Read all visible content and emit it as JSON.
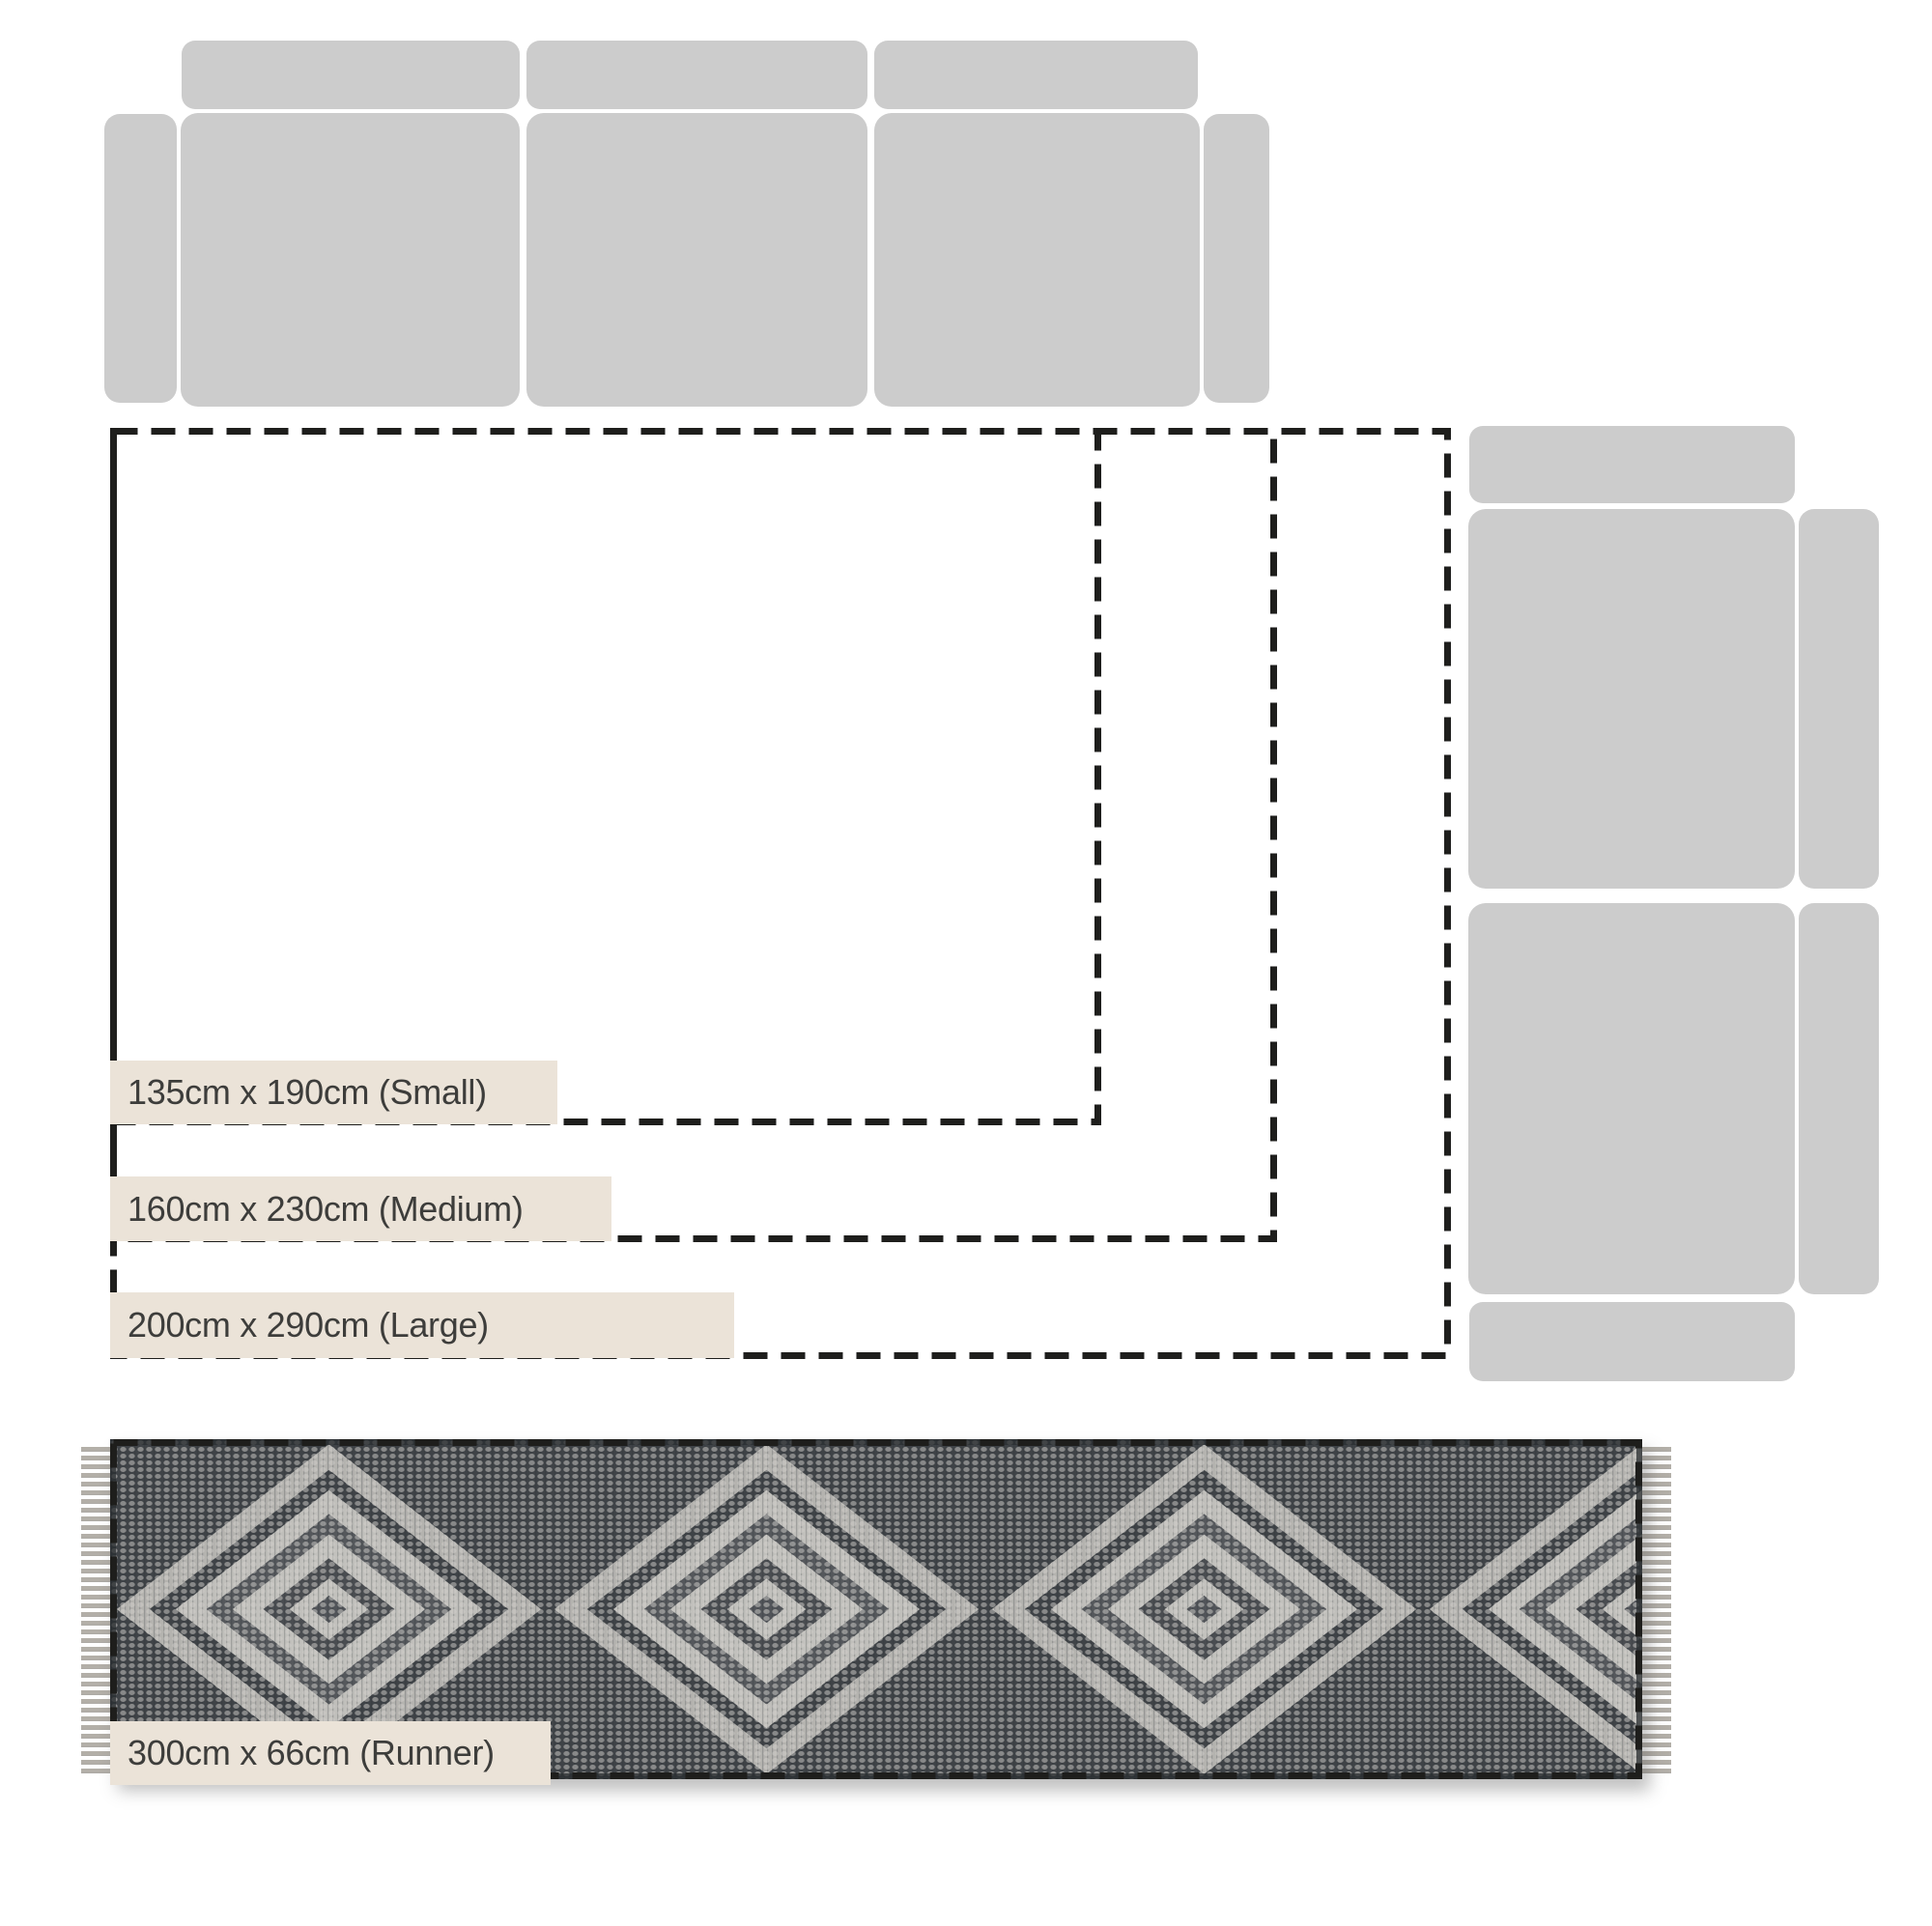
{
  "sizes": {
    "small": {
      "label": "135cm x 190cm (Small)",
      "width_cm": 135,
      "length_cm": 190
    },
    "medium": {
      "label": "160cm x 230cm (Medium)",
      "width_cm": 160,
      "length_cm": 230
    },
    "large": {
      "label": "200cm x 290cm (Large)",
      "width_cm": 200,
      "length_cm": 290
    },
    "runner": {
      "label": "300cm x 66cm (Runner)",
      "width_cm": 66,
      "length_cm": 300
    }
  },
  "colors": {
    "sofa": "#cccccc",
    "label_bg": "#ebe3d8",
    "label_text": "#3d3d3b",
    "dash": "#1e1e1c",
    "rug_light": "#c0bfbb",
    "rug_mid": "#55585c",
    "rug_dark": "#3f4347",
    "fringe": "#b3afa8"
  }
}
